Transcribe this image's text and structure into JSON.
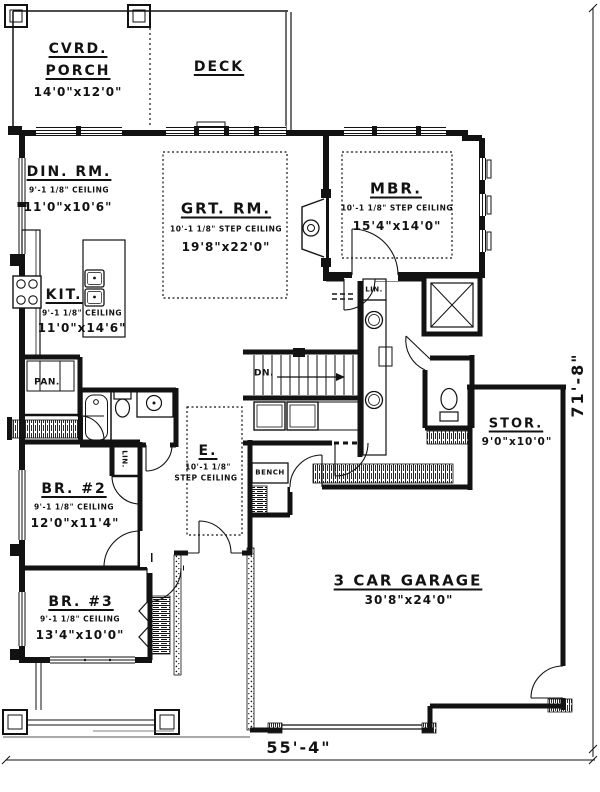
{
  "plan": {
    "rooms": {
      "porch": {
        "name_line1": "CVRD.",
        "name_line2": "PORCH",
        "dims": "14'0\"x12'0\""
      },
      "deck": {
        "name": "DECK"
      },
      "dining": {
        "name": "DIN. RM.",
        "ceiling": "9'-1 1/8\" CEILING",
        "dims": "11'0\"x10'6\""
      },
      "great": {
        "name": "GRT. RM.",
        "ceiling": "10'-1 1/8\" STEP CEILING",
        "dims": "19'8\"x22'0\""
      },
      "master": {
        "name": "MBR.",
        "ceiling": "10'-1 1/8\" STEP CEILING",
        "dims": "15'4\"x14'0\""
      },
      "kitchen": {
        "name": "KIT.",
        "ceiling": "9'-1 1/8\" CEILING",
        "dims": "11'0\"x14'6\""
      },
      "pantry": {
        "name": "PAN."
      },
      "linen_master": {
        "name": "LIN."
      },
      "linen_hall": {
        "name": "LIN."
      },
      "storage": {
        "name": "STOR.",
        "dims": "9'0\"x10'0\""
      },
      "bedroom2": {
        "name": "BR. #2",
        "ceiling": "9'-1 1/8\" CEILING",
        "dims": "12'0\"x11'4\""
      },
      "entry": {
        "name": "E.",
        "ceiling_line1": "10'-1 1/8\"",
        "ceiling_line2": "STEP CEILING"
      },
      "bench": {
        "name": "BENCH"
      },
      "bedroom3": {
        "name": "BR. #3",
        "ceiling": "9'-1 1/8\" CEILING",
        "dims": "13'4\"x10'0\""
      },
      "garage": {
        "name": "3 CAR GARAGE",
        "dims": "30'8\"x24'0\""
      },
      "stairs": {
        "label": "DN."
      }
    },
    "dimensions": {
      "width": "55'-4\"",
      "height": "71'-8\""
    },
    "colors": {
      "ink": "#121212",
      "paper": "#ffffff"
    }
  }
}
